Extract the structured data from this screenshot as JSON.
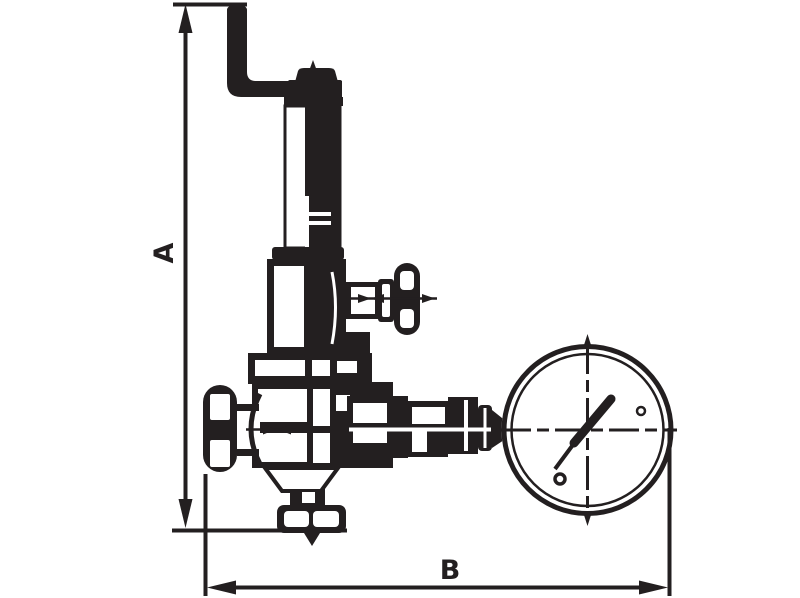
{
  "diagram": {
    "kind": "valve-technical-drawing",
    "description": "Black line technical drawing of a safety relief valve with bent lever handle, spring housing, side handwheel, inlet handwheel, outlet flange and pressure gauge, annotated with overall dimensions",
    "colors": {
      "line": "#231f20",
      "background": "#ffffff"
    },
    "dimension_labels": {
      "a": "A",
      "b": "B"
    },
    "components": [
      "lever-handle",
      "stem-tip",
      "cap-nut",
      "spring-housing",
      "bonnet",
      "side-handwheel",
      "inlet-handwheel",
      "valve-body",
      "outlet-cone",
      "outlet-flange",
      "flow-arrow",
      "gauge-fitting",
      "pressure-gauge",
      "gauge-needle"
    ]
  }
}
